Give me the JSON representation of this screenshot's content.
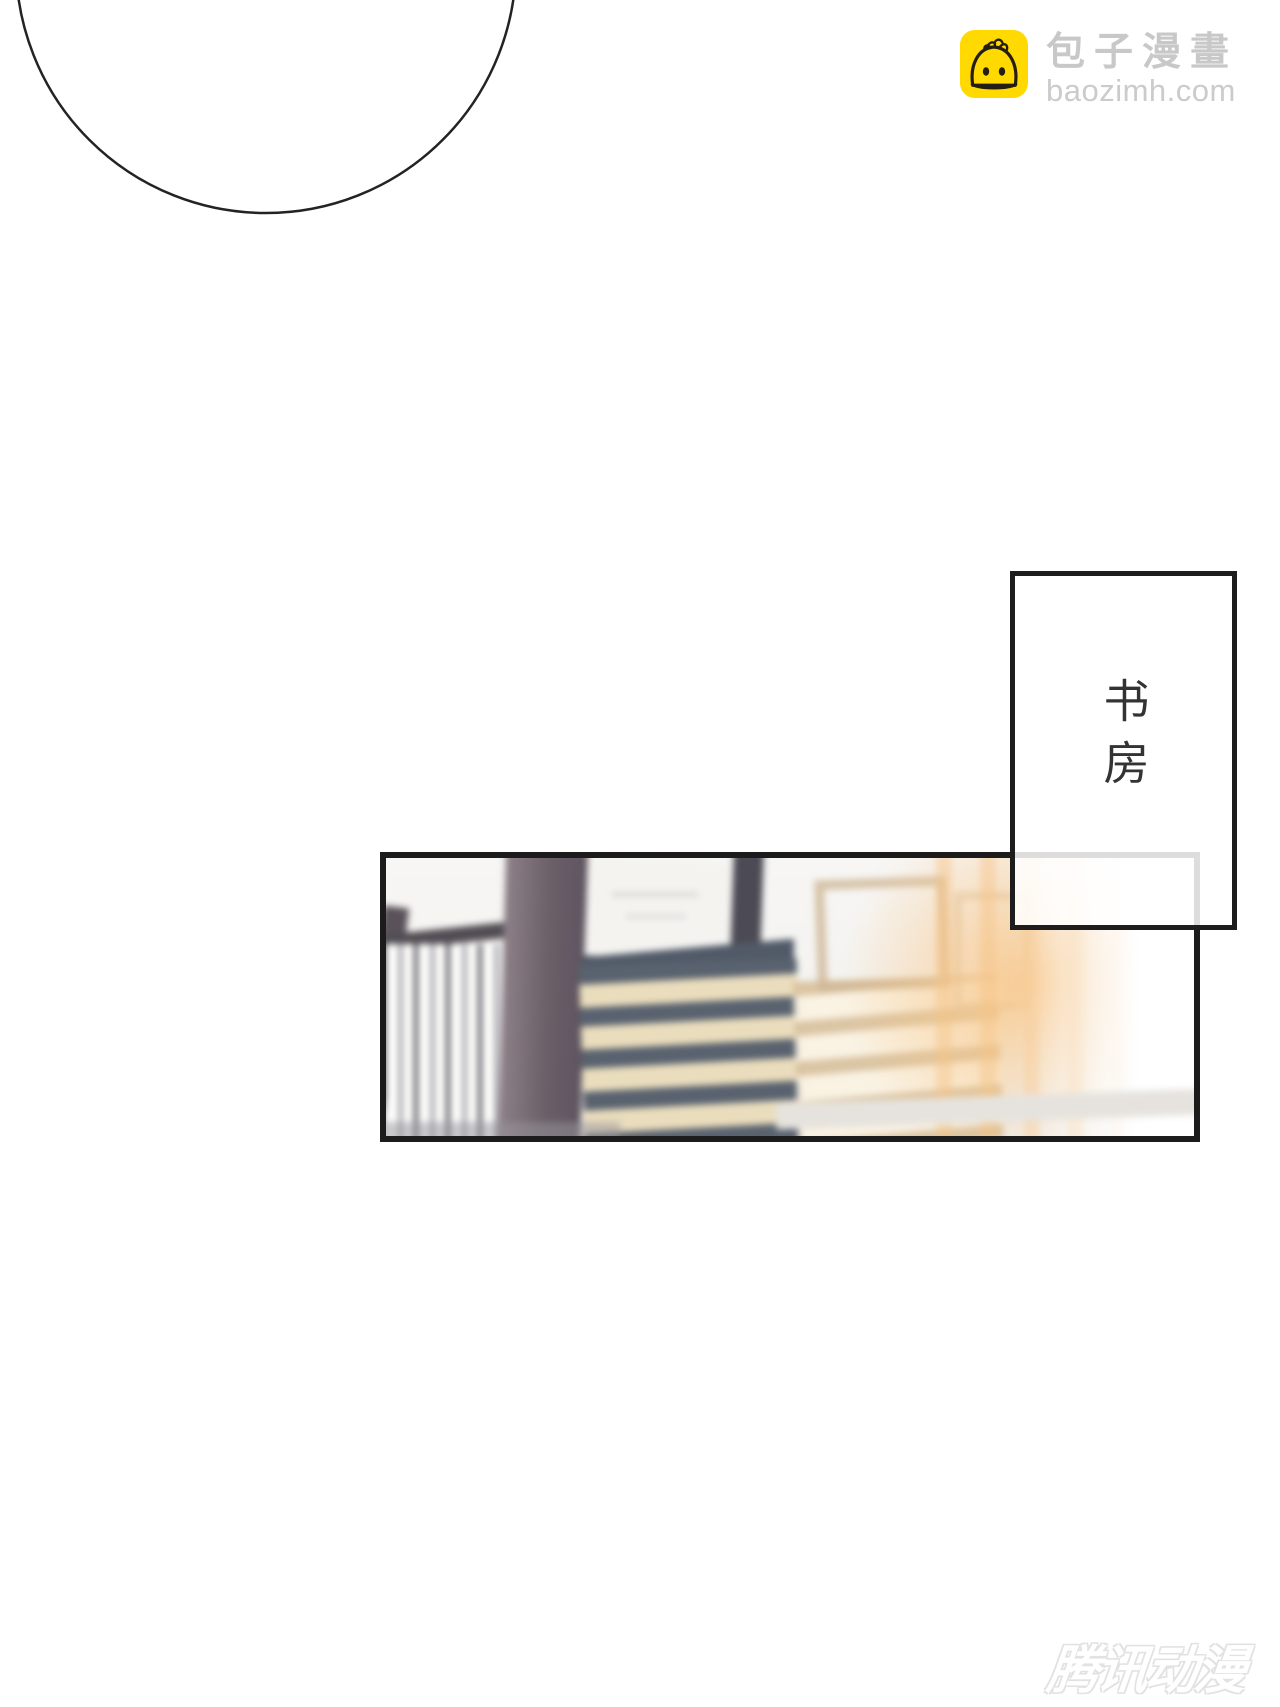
{
  "branding": {
    "site_name": "包子漫畫",
    "site_domain": "baozimh.com",
    "icon_name": "baozi-bun-icon",
    "icon_bg_color": "#ffd900",
    "icon_line_color": "#241e12",
    "text_color": "#c8c8c8"
  },
  "speech_bubble": {
    "style": "large-ellipse-outline-cropped-at-top",
    "stroke_color": "#232323"
  },
  "caption": {
    "text": "书房",
    "border_color": "#1d1d1d",
    "text_color": "#333333"
  },
  "panel": {
    "subject": "blurred bookshelf with stacked books in warm window light",
    "border_color": "#1c1c1c",
    "palette": {
      "wall": "#f6f5f2",
      "wood_post": "#6b5f68",
      "book_cover": "#59626f",
      "book_pages": "#eaddbd",
      "light_glow": "#f8c78a"
    }
  },
  "watermark": {
    "text": "腾讯动漫",
    "outline_color": "#e2e2e2"
  }
}
